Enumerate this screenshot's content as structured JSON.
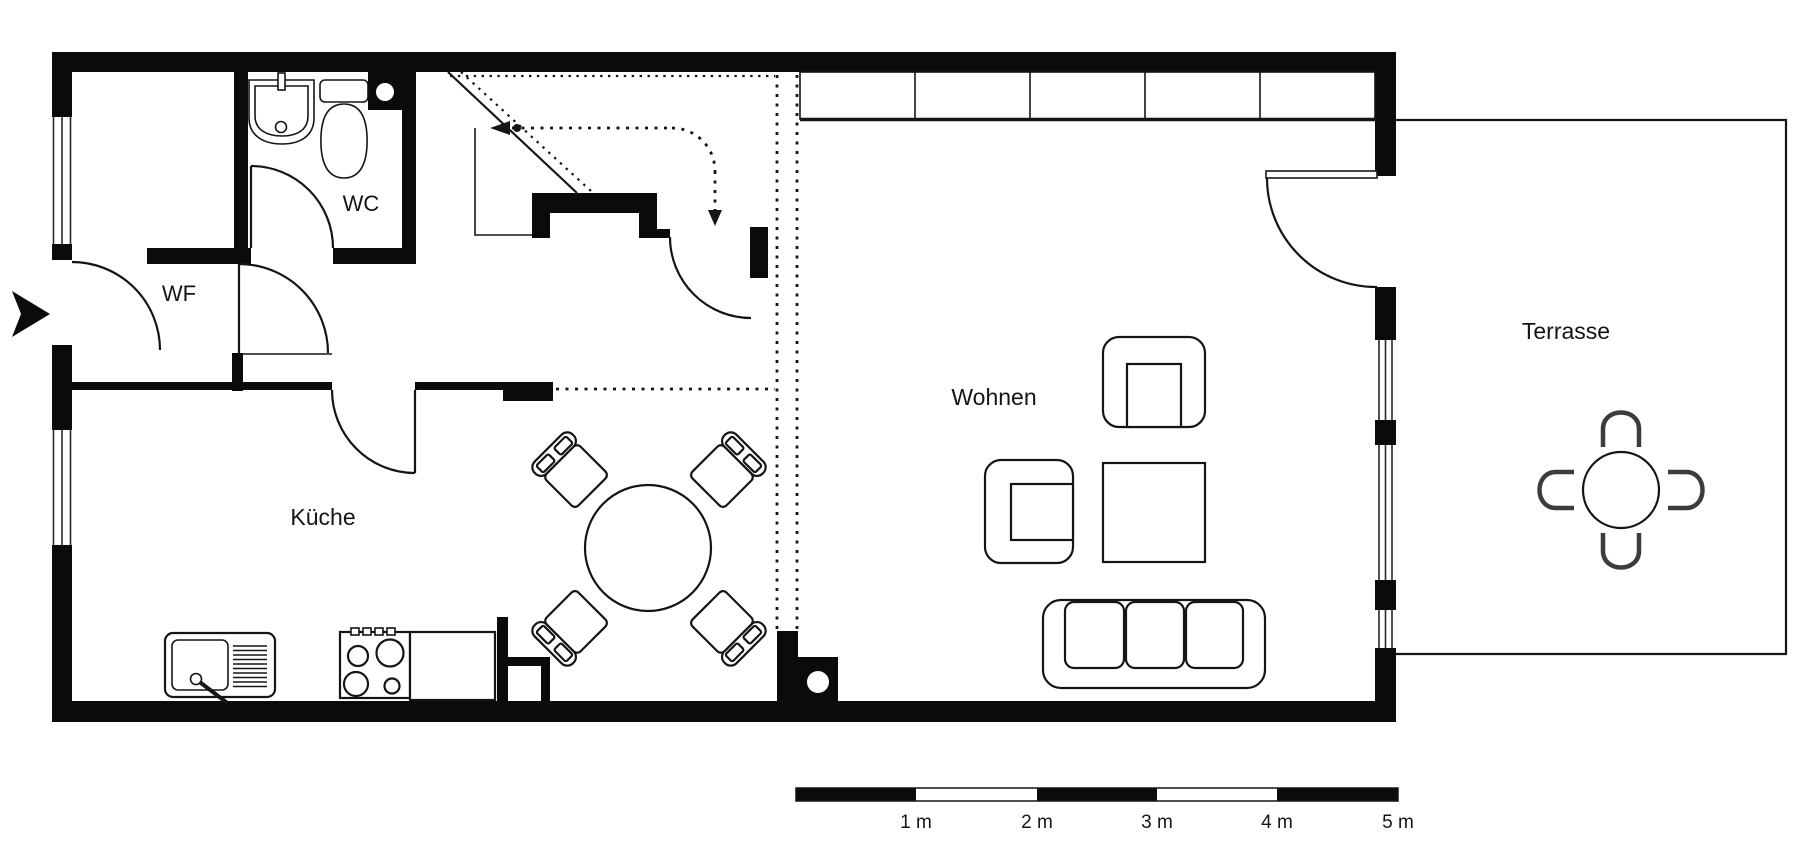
{
  "floorplan": {
    "rooms": {
      "hallway": "WF",
      "wc": "WC",
      "kitchen": "Küche",
      "living": "Wohnen",
      "terrace": "Terrasse"
    },
    "scale_bar": {
      "labels": [
        "1 m",
        "2 m",
        "3 m",
        "4 m",
        "5 m"
      ]
    },
    "colors": {
      "wall": "#0b0b0b",
      "line": "#151515",
      "glazing": "#2a2a2a",
      "background": "#ffffff"
    }
  }
}
